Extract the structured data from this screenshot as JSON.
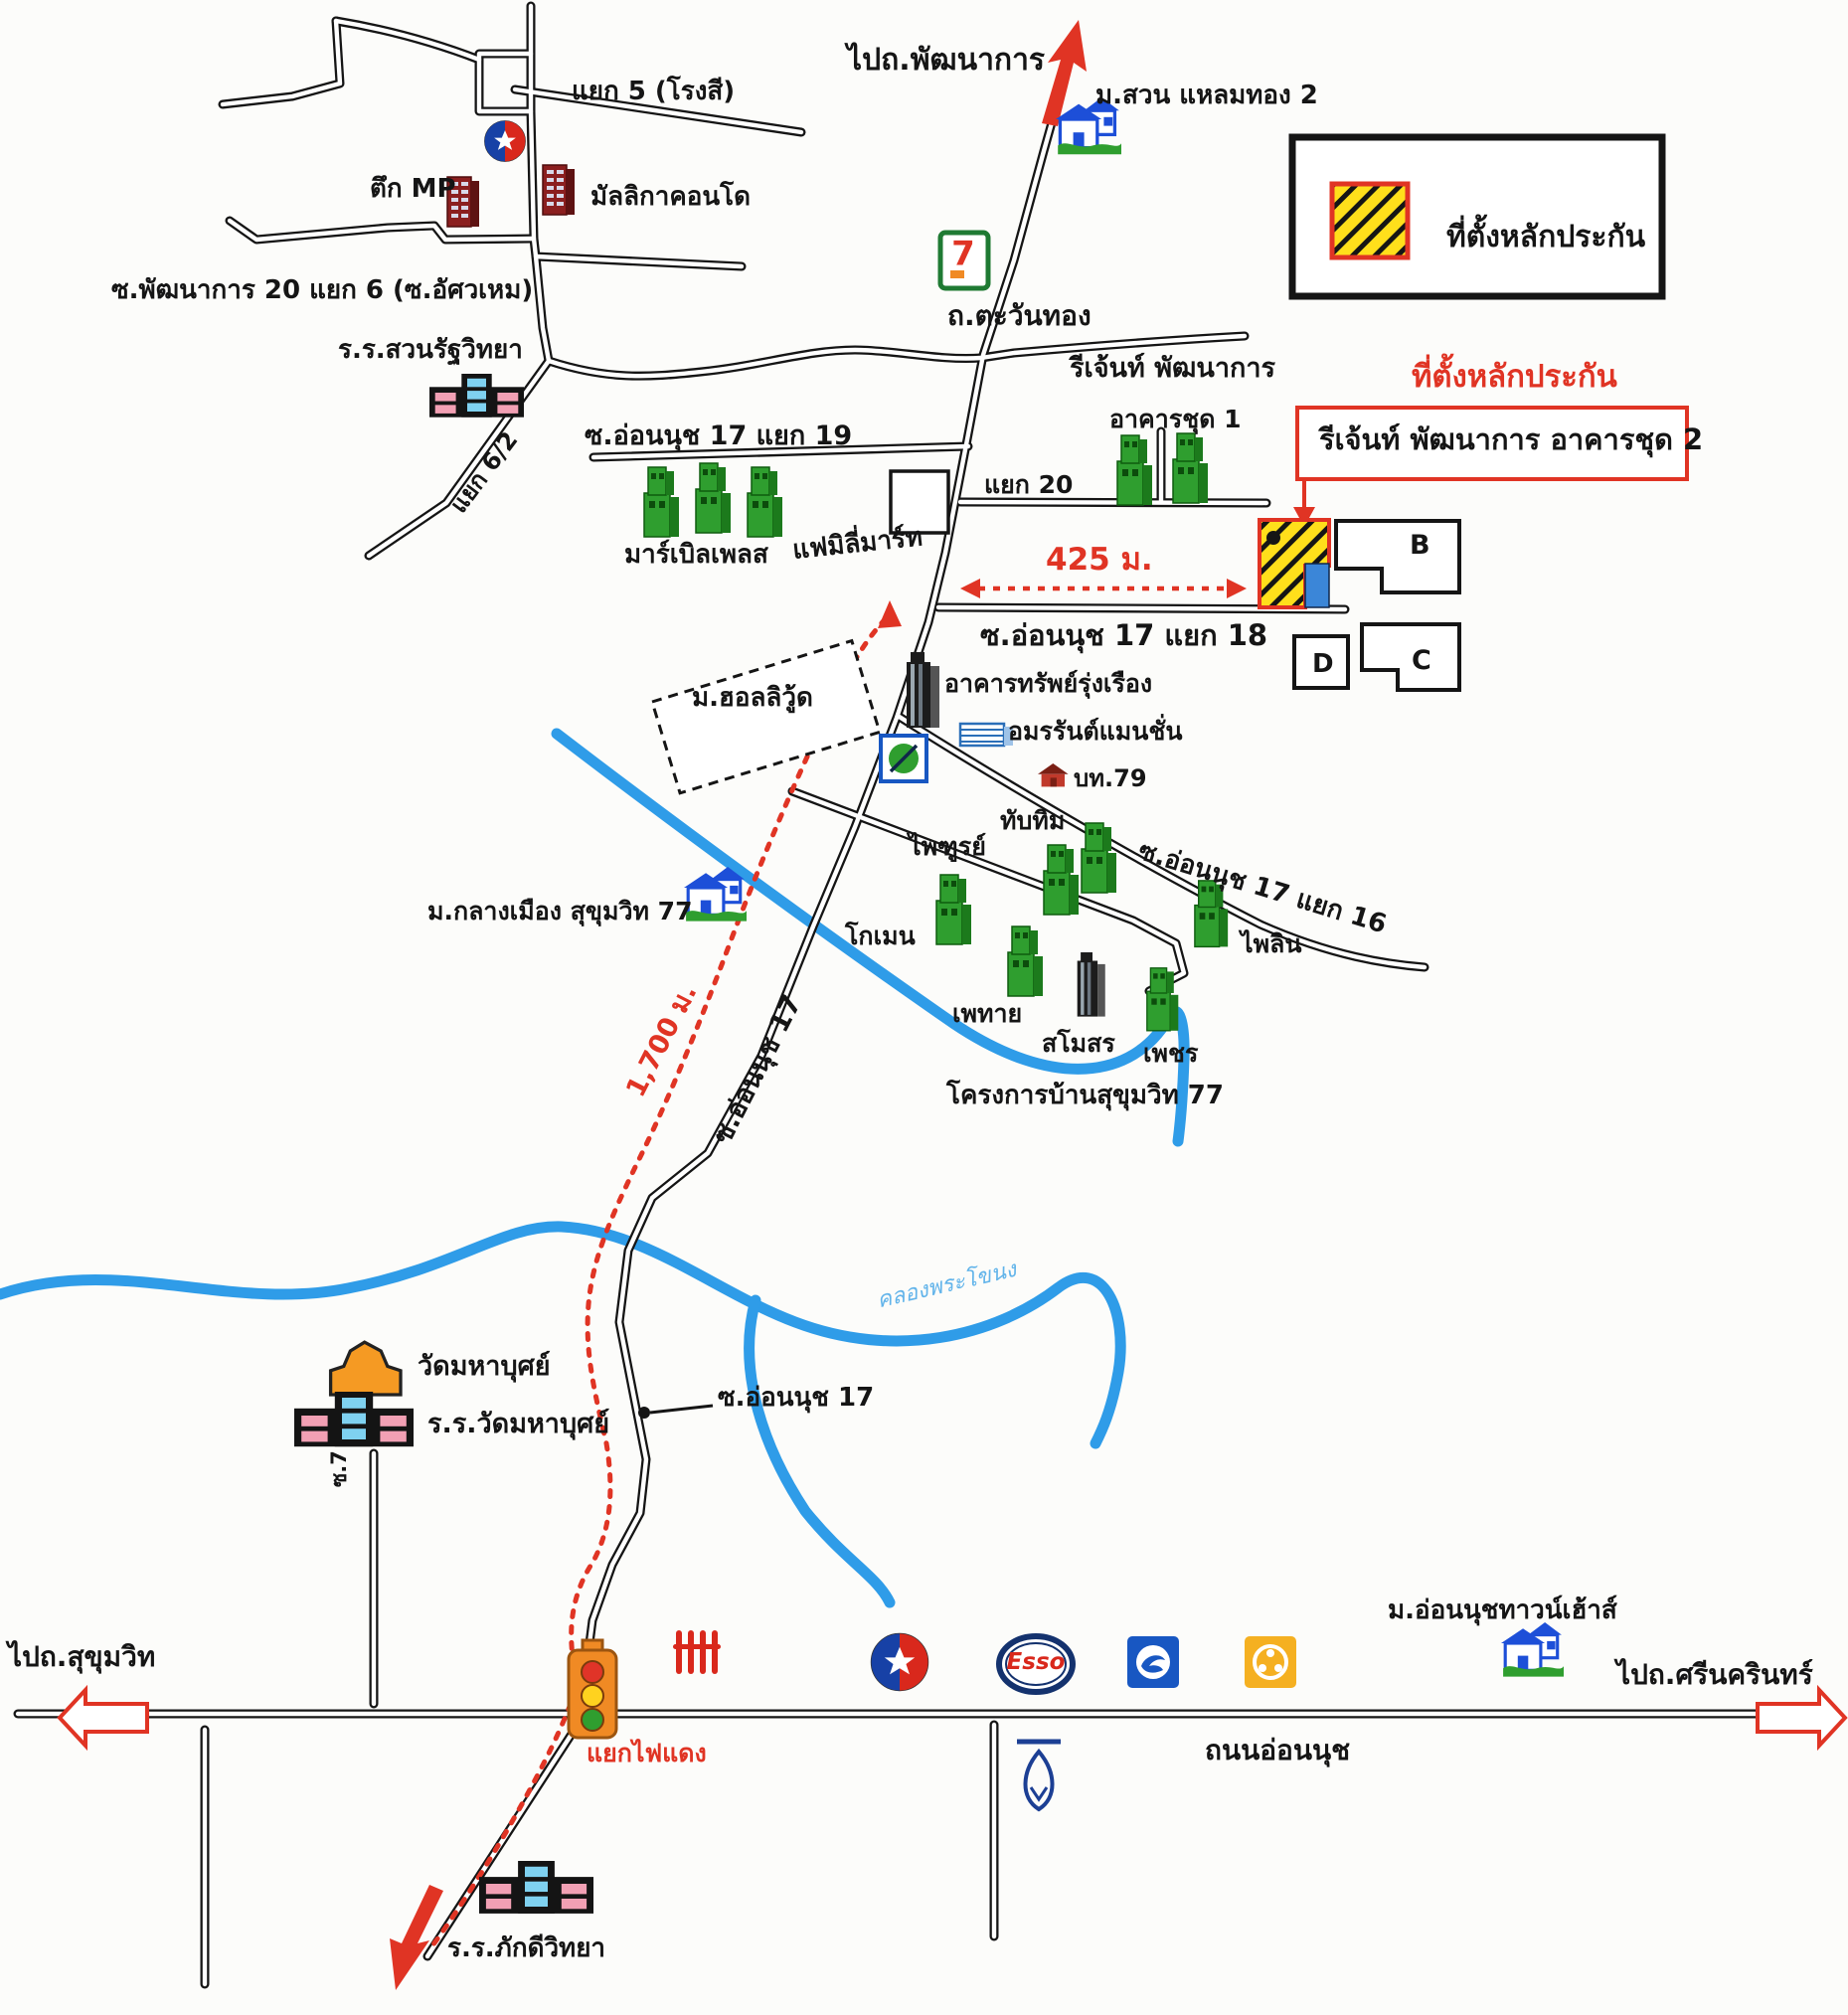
{
  "map": {
    "colors": {
      "road": "#151515",
      "river": "#2f9ce8",
      "route_red": "#e03424",
      "legend_yellow": "#ffdf1b",
      "building_green": "#2f9e2f",
      "condo_red": "#8b1f1f",
      "temple_orange": "#f59a23",
      "annex_blue": "#3b86d8"
    },
    "legend": {
      "label": "ที่ตั้งหลักประกัน"
    },
    "annotation": {
      "title": "ที่ตั้งหลักประกัน",
      "subtitle": "รีเจ้นท์ พัฒนาการ อาคารชุด 2"
    },
    "icons": [
      "school-icon",
      "condo-icon",
      "green-tower-icon",
      "house-icon",
      "temple-icon",
      "seven-eleven-icon",
      "caltex-icon",
      "esso-icon",
      "ktb-bank-icon",
      "krungsri-bank-icon",
      "bangkok-bank-icon",
      "traffic-light-icon",
      "railway-crossing-icon",
      "collateral-hatched-icon",
      "green-circle-logo-icon",
      "office-tower-icon",
      "mansion-icon",
      "small-house-icon"
    ],
    "labels": {
      "yaek5": "แยก 5 (โรงสี)",
      "tuek_mp": "ตึก MP",
      "mallika_condo": "มัลลิกาคอนโด",
      "phatthanakan20": "ซ.พัฒนาการ 20 แยก 6 (ซ.อัศวเหม)",
      "suanrat_school": "ร.ร.สวนรัฐวิทยา",
      "yaek6_2": "แยก 6/2",
      "to_phatthanakan": "ไปถ.พัฒนาการ",
      "suan_laemthong": "ม.สวน แหลมทอง 2",
      "tawanthong_rd": "ถ.ตะวันทอง",
      "regent_phatthanakan": "รีเจ้นท์ พัฒนาการ",
      "akhan_chut1": "อาคารชุด 1",
      "onnut17_yaek19": "ซ.อ่อนนุช 17 แยก 19",
      "yaek20": "แยก 20",
      "marble_place": "มาร์เบิลเพลส",
      "family_mart": "แฟมิลี่มาร์ท",
      "dist425": "425 ม.",
      "onnut17_yaek18": "ซ.อ่อนนุช 17 แยก 18",
      "bldgB": "B",
      "bldgC": "C",
      "bldgD": "D",
      "hollywood": "ม.ฮอลลิวู้ด",
      "sap_rungrueang": "อาคารทรัพย์รุ่งเรือง",
      "amonrat_mansion": "อมรรันต์แมนชั่น",
      "bt79": "บท.79",
      "phaithun": "ไพฑูรย์",
      "thapthim": "ทับทิม",
      "komen": "โกเมน",
      "phethai": "เพทาย",
      "samoson": "สโมสร",
      "phet": "เพชร",
      "phailin": "ไพลิน",
      "onnut17_yaek16": "ซ.อ่อนนุช 17 แยก 16",
      "baan_sukhumvit77": "โครงการบ้านสุขุมวิท 77",
      "klangmueang": "ม.กลางเมือง สุขุมวิท 77",
      "dist1700": "1,700 ม.",
      "onnut17_road": "ซ.อ่อนนุช 17",
      "canal": "คลองพระโขนง",
      "wat_mahabut": "วัดมหาบุศย์",
      "wat_mahabut_school": "ร.ร.วัดมหาบุศย์",
      "soi7": "ซ.7",
      "onnut17_pointer": "ซ.อ่อนนุช 17",
      "to_sukhumvit": "ไปถ.สุขุมวิท",
      "red_light_junction": "แยกไฟแดง",
      "onnut_road": "ถนนอ่อนนุช",
      "onnut_townhouse": "ม.อ่อนนุชทาวน์เฮ้าส์",
      "to_srinakarin": "ไปถ.ศรีนครินทร์",
      "phakdi_school": "ร.ร.ภักดีวิทยา",
      "esso": "Esso",
      "seven": "7"
    }
  }
}
